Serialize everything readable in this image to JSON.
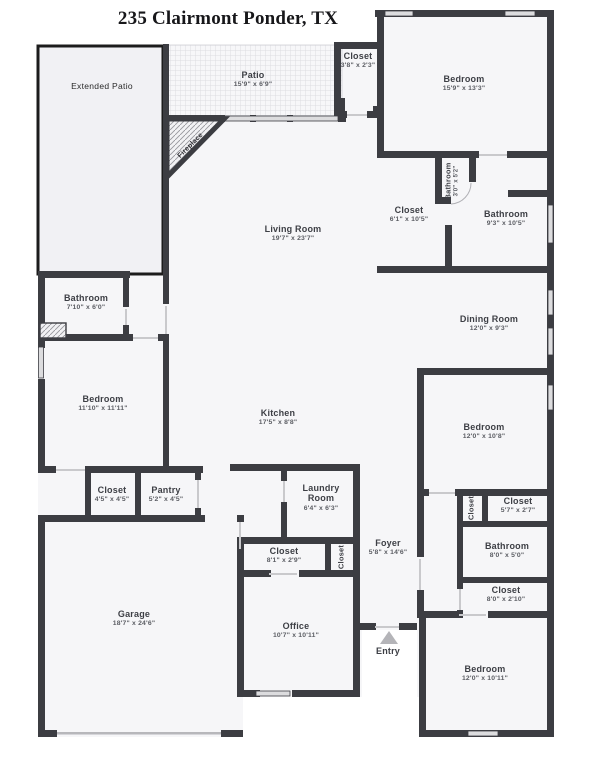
{
  "title": "235 Clairmont Ponder, TX",
  "colors": {
    "wall": "#3c3d42",
    "room_fill": "#f6f6f8",
    "extended_patio_fill": "#f1f1f4",
    "window": "#dcdcde",
    "entry_arrow": "#b4b4b8"
  },
  "rooms": [
    {
      "name": "Extended Patio",
      "dims": ""
    },
    {
      "name": "Patio",
      "dims": "15'9\" x 6'9\""
    },
    {
      "name": "Fireplace",
      "dims": ""
    },
    {
      "name": "Closet",
      "dims": "3'8\" x 2'3\""
    },
    {
      "name": "Bedroom",
      "dims": "15'9\" x 13'3\""
    },
    {
      "name": "Bathroom",
      "dims": "3'0\" x 5'2\""
    },
    {
      "name": "Closet",
      "dims": "6'1\" x 10'5\""
    },
    {
      "name": "Bathroom",
      "dims": "9'3\" x 10'5\""
    },
    {
      "name": "Dining Room",
      "dims": "12'0\" x 9'3\""
    },
    {
      "name": "Living Room",
      "dims": "19'7\" x 23'7\""
    },
    {
      "name": "Bathroom",
      "dims": "7'10\" x 6'0\""
    },
    {
      "name": "Bedroom",
      "dims": "11'10\" x 11'11\""
    },
    {
      "name": "Kitchen",
      "dims": "17'5\" x 8'8\""
    },
    {
      "name": "Closet",
      "dims": "4'5\" x 4'5\""
    },
    {
      "name": "Pantry",
      "dims": "5'2\" x 4'5\""
    },
    {
      "name": "Garage",
      "dims": "18'7\" x 24'6\""
    },
    {
      "name": "Laundry Room",
      "dims": "6'4\" x 6'3\""
    },
    {
      "name": "Closet",
      "dims": "8'1\" x 2'9\""
    },
    {
      "name": "Closet",
      "dims": ""
    },
    {
      "name": "Foyer",
      "dims": "5'8\" x 14'6\""
    },
    {
      "name": "Office",
      "dims": "10'7\" x 10'11\""
    },
    {
      "name": "Bedroom",
      "dims": "12'0\" x 10'8\""
    },
    {
      "name": "Closet",
      "dims": ""
    },
    {
      "name": "Closet",
      "dims": "5'7\" x 2'7\""
    },
    {
      "name": "Bathroom",
      "dims": "8'0\" x 5'0\""
    },
    {
      "name": "Closet",
      "dims": "8'0\" x 2'10\""
    },
    {
      "name": "Bedroom",
      "dims": "12'0\" x 10'11\""
    },
    {
      "name": "Entry",
      "dims": ""
    }
  ]
}
